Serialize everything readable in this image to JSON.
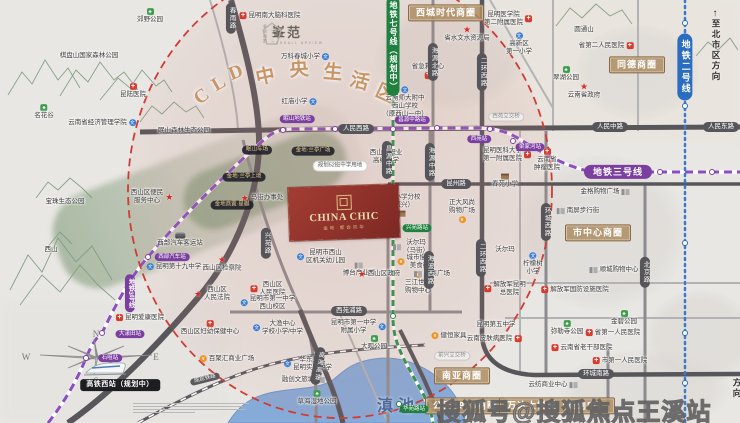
{
  "meta": {
    "watermark": "搜狐号@搜狐焦点王溪站"
  },
  "project": {
    "name_en": "CHINA CHIC",
    "name_cn": "金地·都会风华",
    "brand": "峯范",
    "brand_sub": "CENSALL UPVIEW",
    "brand_company": "金地商置"
  },
  "arc": {
    "title": "CLD中央生活区",
    "color": "#c69668",
    "letters": [
      {
        "c": "C",
        "x": 202,
        "y": 97,
        "r": -38
      },
      {
        "c": "L",
        "x": 219,
        "y": 84,
        "r": -30
      },
      {
        "c": "D",
        "x": 236,
        "y": 73,
        "r": -22
      },
      {
        "c": "中",
        "x": 265,
        "y": 75,
        "r": -12
      },
      {
        "c": "央",
        "x": 299,
        "y": 68,
        "r": -4
      },
      {
        "c": "生",
        "x": 333,
        "y": 71,
        "r": 5
      },
      {
        "c": "活",
        "x": 360,
        "y": 80,
        "r": 15
      },
      {
        "c": "区",
        "x": 386,
        "y": 92,
        "r": 25
      }
    ]
  },
  "lake": {
    "name": "滇池",
    "color": "#86abd9"
  },
  "compass": {
    "n": "N",
    "s": "S",
    "e": "E",
    "w": "W"
  },
  "directions": {
    "north": {
      "text": "至北市区方向",
      "arrow": "↑"
    },
    "south": {
      "text": "至南市区方向"
    }
  },
  "metro": {
    "line2_color": "#2a6cc0",
    "line3_color": "#7b3fa0",
    "line7_color": "#1f8040"
  },
  "pills": [
    {
      "t": "人民西路",
      "x": 356,
      "y": 129,
      "c": "road-h"
    },
    {
      "t": "人民中路",
      "x": 610,
      "y": 127,
      "c": "road-h"
    },
    {
      "t": "人民东路",
      "x": 721,
      "y": 127,
      "c": "road-h"
    },
    {
      "t": "昆州路",
      "x": 456,
      "y": 184,
      "c": "road-h"
    },
    {
      "t": "西苑浦路",
      "x": 349,
      "y": 311,
      "c": "road-h"
    },
    {
      "t": "环城南路",
      "x": 596,
      "y": 374,
      "c": "road-h"
    },
    {
      "t": "春雨路",
      "x": 231,
      "y": 18,
      "c": "road-v"
    },
    {
      "t": "兴苑路",
      "x": 266,
      "y": 243,
      "c": "road-v"
    },
    {
      "t": "昌源中路",
      "x": 387,
      "y": 160,
      "c": "road-v"
    },
    {
      "t": "海源北路",
      "x": 433,
      "y": 62,
      "c": "road-v"
    },
    {
      "t": "海源中路",
      "x": 430,
      "y": 162,
      "c": "road-v"
    },
    {
      "t": "海波西路",
      "x": 429,
      "y": 270,
      "c": "road-v"
    },
    {
      "t": "二环西路",
      "x": 482,
      "y": 72,
      "c": "road-v"
    },
    {
      "t": "二环西路",
      "x": 481,
      "y": 258,
      "c": "road-v"
    },
    {
      "t": "环城西路",
      "x": 546,
      "y": 222,
      "c": "road-v"
    },
    {
      "t": "北京路",
      "x": 645,
      "y": 272,
      "c": "road-v"
    },
    {
      "t": "高海高速",
      "x": 318,
      "y": 366,
      "c": "road-v",
      "r": 10
    },
    {
      "t": "成昆铁路",
      "x": 205,
      "y": 379,
      "c": "rail",
      "r": -14
    },
    {
      "t": "西苑立交桥",
      "x": 506,
      "y": 117,
      "c": "light"
    },
    {
      "t": "前兴立交桥",
      "x": 452,
      "y": 356,
      "c": "light"
    },
    {
      "t": "西城时代商圈",
      "x": 446,
      "y": 13,
      "c": "biz"
    },
    {
      "t": "同德商圈",
      "x": 637,
      "y": 65,
      "c": "biz"
    },
    {
      "t": "市中心商圈",
      "x": 598,
      "y": 233,
      "c": "biz"
    },
    {
      "t": "南亚商圈",
      "x": 462,
      "y": 376,
      "c": "biz"
    },
    {
      "t": "公园1903商圈",
      "x": 465,
      "y": 406,
      "c": "biz"
    },
    {
      "t": "万达大悦城（规划中）",
      "x": 557,
      "y": 406,
      "c": "biz"
    },
    {
      "t": "眠山车场",
      "x": 257,
      "y": 150,
      "c": "dark"
    },
    {
      "t": "金地·兰亭广场",
      "x": 313,
      "y": 151,
      "c": "dark"
    },
    {
      "t": "金地·兰亭上境",
      "x": 244,
      "y": 177,
      "c": "dark"
    },
    {
      "t": "金地商置·星樾",
      "x": 232,
      "y": 205,
      "c": "dark"
    },
    {
      "t": "规划52班中学用地",
      "x": 340,
      "y": 166,
      "c": "white"
    },
    {
      "t": "高铁西站（规划中）",
      "x": 120,
      "y": 385,
      "c": "black"
    },
    {
      "t": "地铁三号线",
      "x": 618,
      "y": 172,
      "c": "line3h"
    },
    {
      "t": "地铁3号线",
      "x": 130,
      "y": 293,
      "c": "line3v"
    },
    {
      "t": "地铁七号线（规划中）",
      "x": 393,
      "y": 46,
      "c": "line7v"
    },
    {
      "t": "地铁二号线",
      "x": 685,
      "y": 67,
      "c": "line2v"
    },
    {
      "t": "石咀站",
      "x": 110,
      "y": 358,
      "c": "m3"
    },
    {
      "t": "大漾田站",
      "x": 130,
      "y": 334,
      "c": "m3"
    },
    {
      "t": "西部汽车站",
      "x": 172,
      "y": 257,
      "c": "m3"
    },
    {
      "t": "眠山地铁站",
      "x": 297,
      "y": 119,
      "c": "m3"
    },
    {
      "t": "昌源中路站",
      "x": 412,
      "y": 120,
      "c": "m3"
    },
    {
      "t": "西苑站",
      "x": 479,
      "y": 139,
      "c": "m3"
    },
    {
      "t": "梁家河站",
      "x": 530,
      "y": 147,
      "c": "m3"
    },
    {
      "t": "兴苑路站",
      "x": 417,
      "y": 228,
      "c": "m7"
    },
    {
      "t": "华苑路站",
      "x": 414,
      "y": 409,
      "c": "m7"
    }
  ],
  "stations": [
    {
      "x": 86,
      "y": 358,
      "l": "3"
    },
    {
      "x": 102,
      "y": 333,
      "l": "3"
    },
    {
      "x": 148,
      "y": 257,
      "l": "3"
    },
    {
      "x": 283,
      "y": 130,
      "l": "3"
    },
    {
      "x": 335,
      "y": 129,
      "l": "3"
    },
    {
      "x": 393,
      "y": 129,
      "l": "3"
    },
    {
      "x": 437,
      "y": 128,
      "l": "3"
    },
    {
      "x": 490,
      "y": 129,
      "l": "3"
    },
    {
      "x": 513,
      "y": 141,
      "l": "3"
    },
    {
      "x": 660,
      "y": 172,
      "l": "3"
    },
    {
      "x": 712,
      "y": 172,
      "l": "3"
    },
    {
      "x": 393,
      "y": 60,
      "l": "7"
    },
    {
      "x": 393,
      "y": 235,
      "l": "7"
    },
    {
      "x": 393,
      "y": 316,
      "l": "7"
    },
    {
      "x": 399,
      "y": 404,
      "l": "7"
    },
    {
      "x": 685,
      "y": 23,
      "l": "2"
    },
    {
      "x": 685,
      "y": 106,
      "l": "2"
    },
    {
      "x": 685,
      "y": 243,
      "l": "2"
    },
    {
      "x": 685,
      "y": 333,
      "l": "2"
    },
    {
      "x": 685,
      "y": 383,
      "l": "2"
    }
  ],
  "pois": [
    {
      "i": "p",
      "t": "郊野公园",
      "x": 150,
      "y": 16,
      "a": "it"
    },
    {
      "i": "n",
      "t": "棋盘山国家森林公园",
      "x": 89,
      "y": 56,
      "a": "c"
    },
    {
      "i": "h",
      "t": "昆陆医院",
      "x": 133,
      "y": 91,
      "a": "it"
    },
    {
      "i": "p",
      "t": "名花谷",
      "x": 44,
      "y": 112,
      "a": "it"
    },
    {
      "i": "s",
      "t": "云南省经济管理学院",
      "x": 102,
      "y": 123,
      "a": "ir"
    },
    {
      "i": "n",
      "t": "眠山森林生态公园",
      "x": 184,
      "y": 131,
      "a": "c"
    },
    {
      "i": "n",
      "t": "宝珠生态公园",
      "x": 65,
      "y": 202,
      "a": "c"
    },
    {
      "i": "n",
      "t": "西山",
      "x": 51,
      "y": 250,
      "a": "c"
    },
    {
      "i": "g",
      "t": "西山区便民\n服务中心",
      "x": 152,
      "y": 197,
      "a": "ir"
    },
    {
      "i": "h",
      "t": "昆明南大脑科医院",
      "x": 270,
      "y": 16,
      "a": "il"
    },
    {
      "i": "s",
      "t": "万科春城小学",
      "x": 305,
      "y": 57,
      "a": "ir"
    },
    {
      "i": "s",
      "t": "红庙小学",
      "x": 299,
      "y": 102,
      "a": "ir"
    },
    {
      "i": "h",
      "t": "昆明医学院\n第二附属医院",
      "x": 508,
      "y": 19,
      "a": "ir"
    },
    {
      "i": "s",
      "t": "高新区\n第一小学",
      "x": 519,
      "y": 44,
      "a": "it"
    },
    {
      "i": "h",
      "t": "省第二人民医院",
      "x": 606,
      "y": 46,
      "a": "ir"
    },
    {
      "i": "n",
      "t": "圆通山",
      "x": 584,
      "y": 30,
      "a": "c"
    },
    {
      "i": "p",
      "t": "翠湖公园",
      "x": 566,
      "y": 74,
      "a": "it"
    },
    {
      "i": "g",
      "t": "云南省政府",
      "x": 584,
      "y": 91,
      "a": "it"
    },
    {
      "i": "g",
      "t": "省水文水资源局",
      "x": 467,
      "y": 34,
      "a": "it"
    },
    {
      "i": "h",
      "t": "省急救中心",
      "x": 428,
      "y": 71,
      "a": "ib"
    },
    {
      "i": "s",
      "t": "云南师大附中\n西山学校\n（原西山一中）",
      "x": 405,
      "y": 102,
      "a": "it"
    },
    {
      "i": "s",
      "t": "西山区职业\n高级中学",
      "x": 386,
      "y": 153,
      "a": "it"
    },
    {
      "i": "h",
      "t": "云南省\n肿瘤医院",
      "x": 547,
      "y": 160,
      "a": "it"
    },
    {
      "i": "h",
      "t": "昆明医科大学\n第一附属医院",
      "x": 507,
      "y": 155,
      "a": "ir"
    },
    {
      "i": "e",
      "t": "春苑小学",
      "x": 505,
      "y": 181,
      "a": "it"
    },
    {
      "i": "b",
      "t": "金格购物广场",
      "x": 605,
      "y": 192,
      "a": "ir"
    },
    {
      "i": "e",
      "t": "春苑小学分校\n（振兴）",
      "x": 401,
      "y": 205,
      "a": "ib"
    },
    {
      "i": "g",
      "t": "马街办事处",
      "x": 262,
      "y": 198,
      "a": "il"
    },
    {
      "i": "o",
      "t": "正大风尚\n购物广场",
      "x": 462,
      "y": 211,
      "a": "ib"
    },
    {
      "i": "b",
      "t": "南屏步行街",
      "x": 578,
      "y": 211,
      "a": "il"
    },
    {
      "i": "b",
      "t": "博台产业园",
      "x": 359,
      "y": 270,
      "a": "it"
    },
    {
      "i": "t",
      "t": "西部汽车客运站",
      "x": 180,
      "y": 240,
      "a": "it"
    },
    {
      "i": "s",
      "t": "昆明第十九中学",
      "x": 174,
      "y": 267,
      "a": "il"
    },
    {
      "i": "g",
      "t": "西山区检察院",
      "x": 222,
      "y": 264,
      "a": "it"
    },
    {
      "i": "g",
      "t": "西山区\n人民法院",
      "x": 212,
      "y": 294,
      "a": "il"
    },
    {
      "i": "s",
      "t": "昆明市西山\n区机关幼儿园",
      "x": 321,
      "y": 257,
      "a": "il"
    },
    {
      "i": "b",
      "t": "沃尔玛\n（马街）",
      "x": 411,
      "y": 247,
      "a": "il"
    },
    {
      "i": "o",
      "t": "城市慢地\n美食街",
      "x": 415,
      "y": 262,
      "a": "il"
    },
    {
      "i": "o",
      "t": "三江世纪\n购物中心",
      "x": 418,
      "y": 283,
      "a": "it"
    },
    {
      "i": "b",
      "t": "沃尔玛",
      "x": 505,
      "y": 250,
      "a": "c"
    },
    {
      "i": "s",
      "t": "柠檬树\n小学",
      "x": 533,
      "y": 264,
      "a": "it"
    },
    {
      "i": "b",
      "t": "顺城购物中心",
      "x": 614,
      "y": 270,
      "a": "il"
    },
    {
      "i": "g",
      "t": "西山区政府",
      "x": 379,
      "y": 274,
      "a": "il"
    },
    {
      "i": "b",
      "t": "颐商广场",
      "x": 432,
      "y": 274,
      "a": "il"
    },
    {
      "i": "h",
      "t": "西山区\n人民医院",
      "x": 268,
      "y": 289,
      "a": "il"
    },
    {
      "i": "h",
      "t": "解放军昆明\n总医院",
      "x": 505,
      "y": 289,
      "a": "il"
    },
    {
      "i": "h",
      "t": "解放军国防设施医院",
      "x": 575,
      "y": 290,
      "a": "il"
    },
    {
      "i": "s",
      "t": "昆明市第一中学\n西山校区",
      "x": 268,
      "y": 303,
      "a": "il"
    },
    {
      "i": "h",
      "t": "昆明爱康医院",
      "x": 140,
      "y": 318,
      "a": "il"
    },
    {
      "i": "h",
      "t": "西山区妇幼保健中心",
      "x": 210,
      "y": 328,
      "a": "it"
    },
    {
      "i": "s",
      "t": "大渔中心\n学校小学/中学",
      "x": 278,
      "y": 328,
      "a": "il"
    },
    {
      "i": "s",
      "t": "昆明市第一中学\n附属小学",
      "x": 358,
      "y": 327,
      "a": "ir"
    },
    {
      "i": "n",
      "t": "昆明第五中学",
      "x": 496,
      "y": 325,
      "a": "c"
    },
    {
      "i": "h",
      "t": "云南皮肤病医院",
      "x": 494,
      "y": 339,
      "a": "ir"
    },
    {
      "i": "p",
      "t": "金碧公园",
      "x": 624,
      "y": 318,
      "a": "it"
    },
    {
      "i": "p",
      "t": "弥勒寺公园",
      "x": 567,
      "y": 328,
      "a": "it"
    },
    {
      "i": "h",
      "t": "省第一人民医院",
      "x": 613,
      "y": 333,
      "a": "il"
    },
    {
      "i": "o",
      "t": "健恒家具",
      "x": 449,
      "y": 336,
      "a": "il"
    },
    {
      "i": "h",
      "t": "云南省老干部医院",
      "x": 582,
      "y": 348,
      "a": "il"
    },
    {
      "i": "h",
      "t": "市第一人民医院",
      "x": 620,
      "y": 361,
      "a": "il"
    },
    {
      "i": "o",
      "t": "百聚汇商业广场",
      "x": 227,
      "y": 359,
      "a": "il"
    },
    {
      "i": "s",
      "t": "华东师大\n昆明实验中学",
      "x": 308,
      "y": 364,
      "a": "il"
    },
    {
      "i": "b",
      "t": "融创文旅城",
      "x": 303,
      "y": 380,
      "a": "ir"
    },
    {
      "i": "p",
      "t": "大观公园",
      "x": 374,
      "y": 343,
      "a": "it"
    },
    {
      "i": "p",
      "t": "草海湿地公园",
      "x": 317,
      "y": 398,
      "a": "it"
    },
    {
      "i": "b",
      "t": "云纺商业中心",
      "x": 553,
      "y": 385,
      "a": "ir"
    }
  ]
}
